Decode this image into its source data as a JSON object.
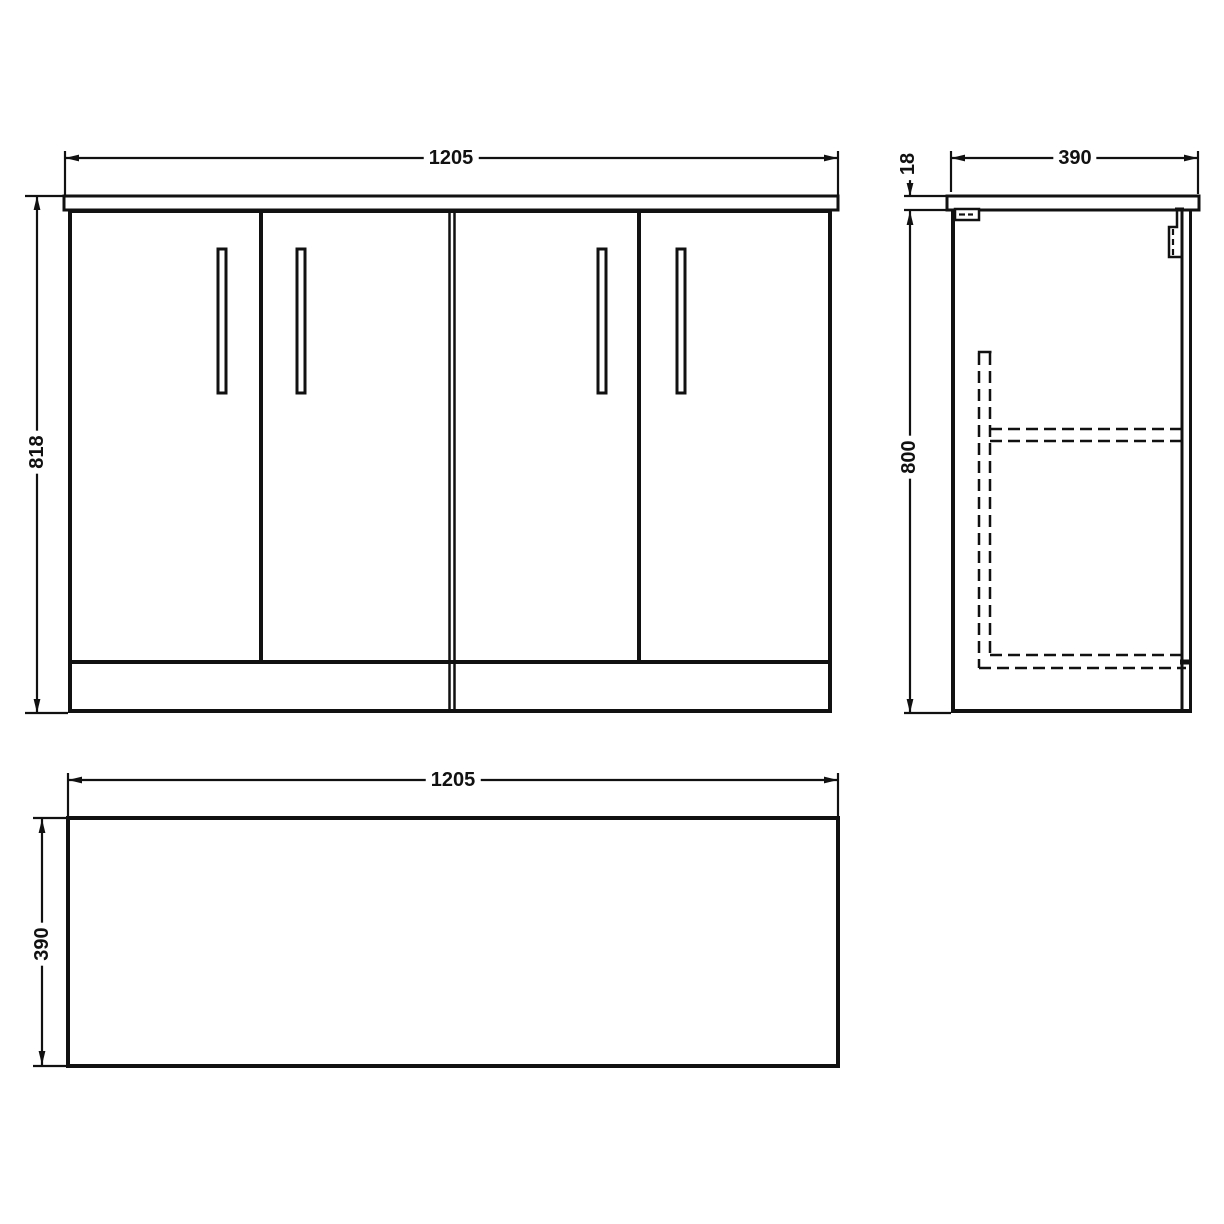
{
  "dimensions": {
    "front": {
      "width": "1205",
      "height": "818"
    },
    "side": {
      "depth": "390",
      "worktop_thickness": "18",
      "cabinet_height": "800"
    },
    "plan": {
      "width": "1205",
      "depth": "390"
    }
  },
  "colors": {
    "line": "#111111",
    "background": "#ffffff"
  }
}
